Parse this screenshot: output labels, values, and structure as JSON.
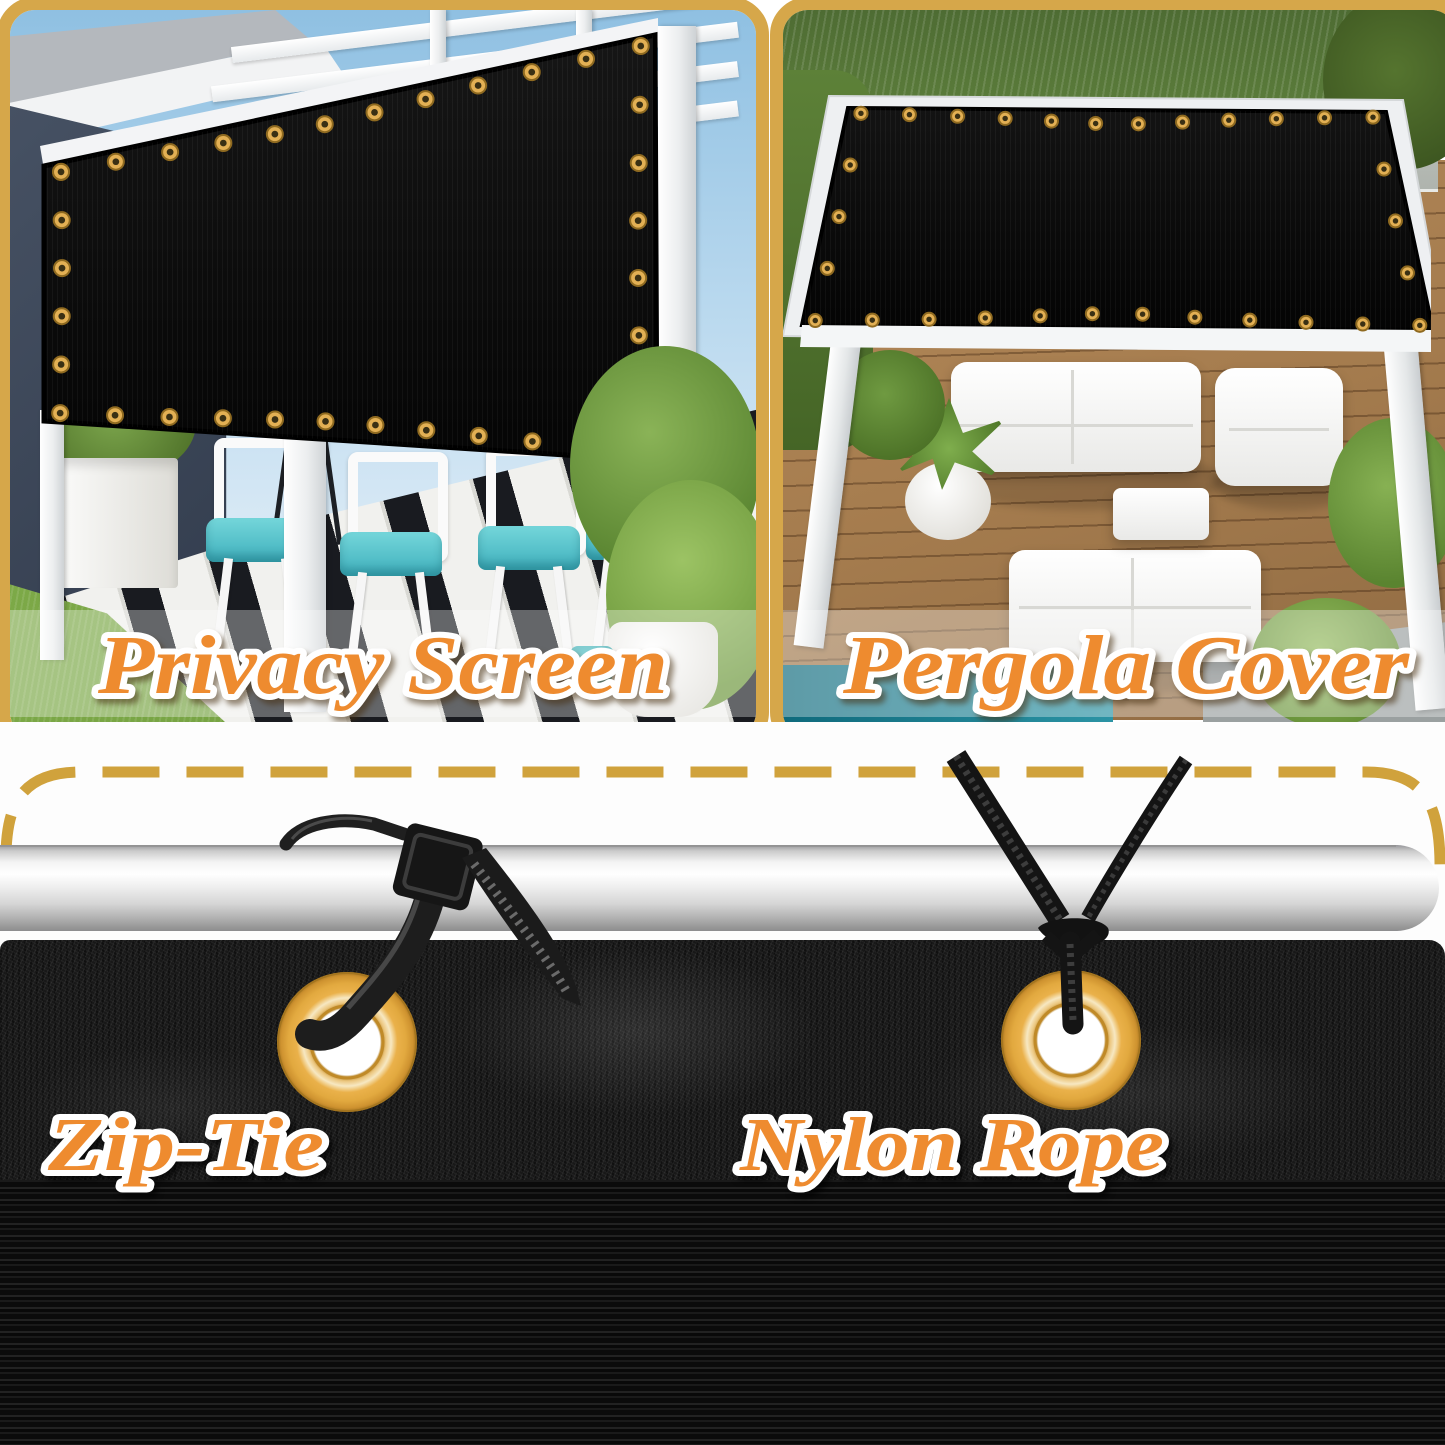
{
  "panels": {
    "privacy_screen": {
      "label": "Privacy Screen"
    },
    "pergola_cover": {
      "label": "Pergola Cover"
    }
  },
  "installation": {
    "zip_tie_label": "Zip-Tie",
    "nylon_rope_label": "Nylon Rope"
  },
  "colors": {
    "frame_gold": "#D6A74A",
    "dash_gold": "#D0A23C",
    "label_orange": "#EE8B2F",
    "grommet_gold": "#E2A93F",
    "fabric_black": "#111111",
    "cushion_teal": "#4FC0C8",
    "pole_silver": "#E9E9E9"
  }
}
